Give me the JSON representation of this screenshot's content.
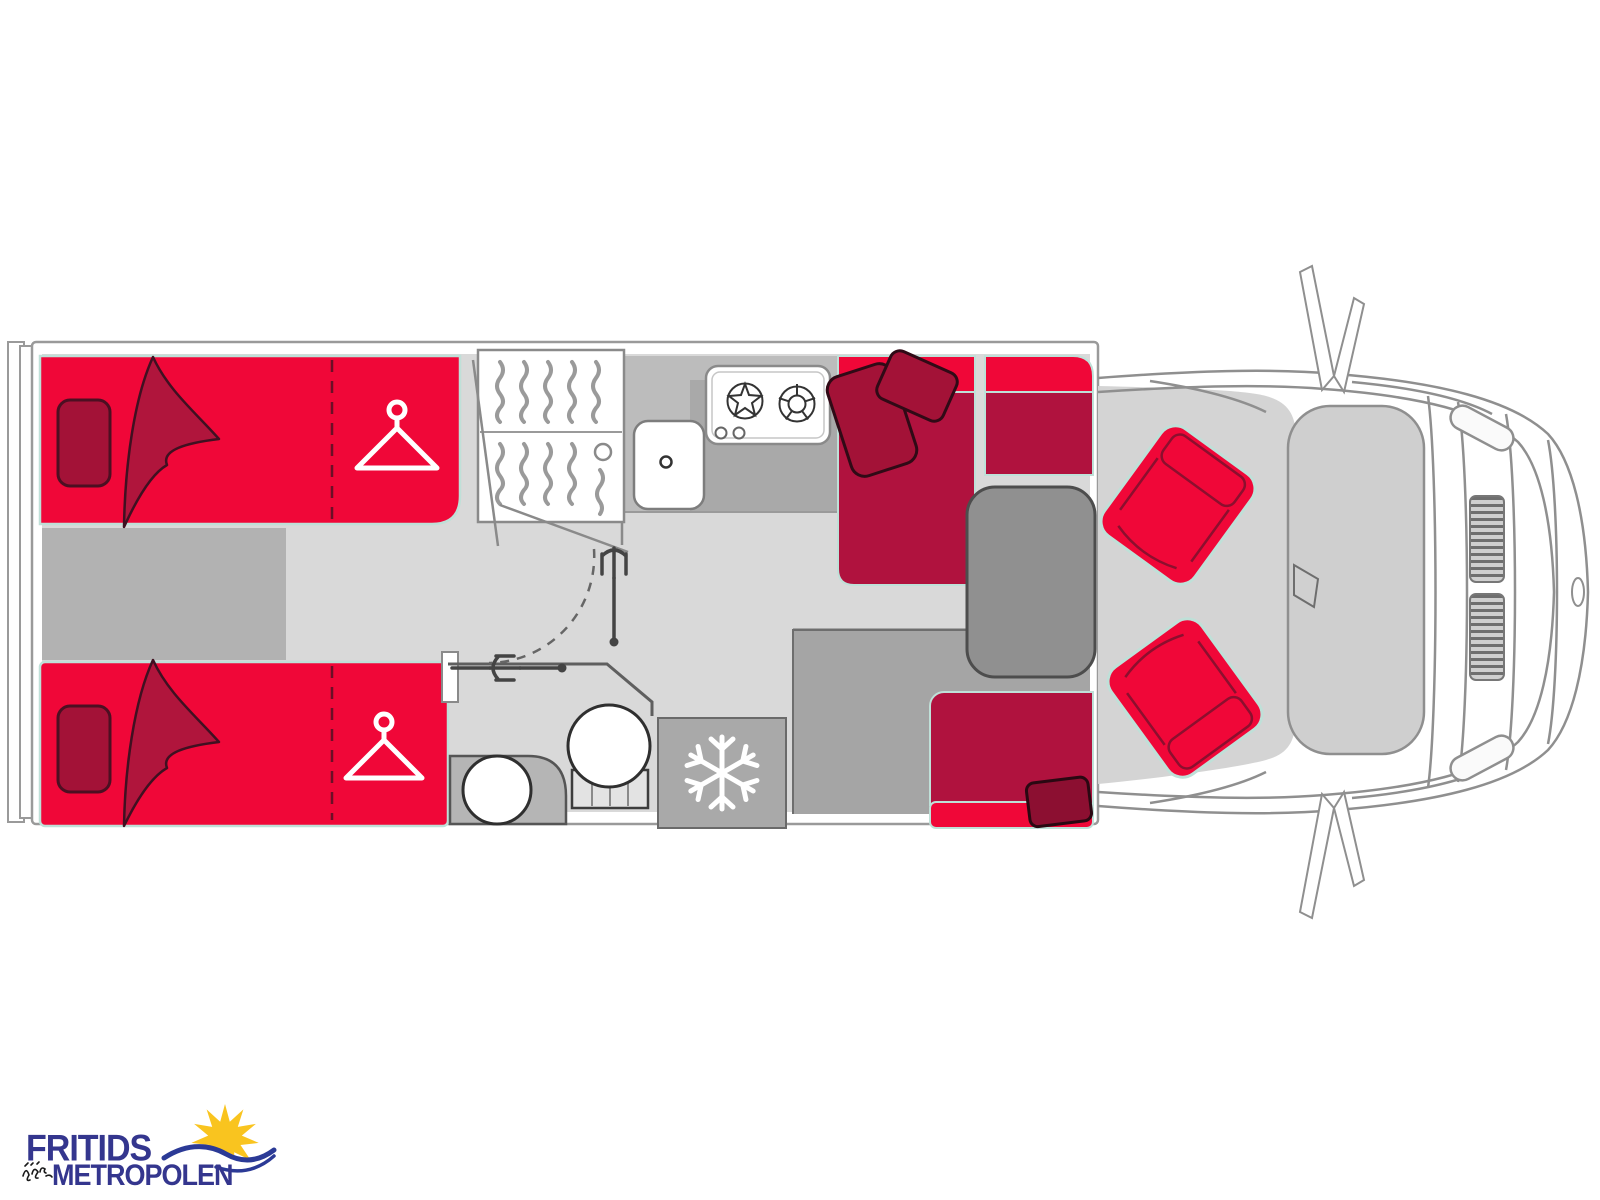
{
  "page": {
    "width": 1600,
    "height": 1200,
    "background": "#ffffff"
  },
  "logo": {
    "line1": "FRITIDS",
    "line2": "METROPOLEN",
    "text_color": "#34368e",
    "sun_color": "#f9c41f",
    "wave_color": "#2b3a96",
    "doodle_color": "#1a1a1a"
  },
  "floorplan": {
    "description": "Motorhome floor plan, top view: rear twin single beds with under-bed wardrobes, shelf unit, kitchen with sink and two-burner stove, bathroom with toilet and washbasin, refrigerator, dinette with L-sofa and table, two red swivel cab seats, van cab front outline",
    "colors": {
      "upholstery_red": "#f00738",
      "upholstery_dark_red": "#b0123e",
      "pillow_red": "#a31237",
      "trim_mint": "#bfe0d8",
      "floor_light": "#d9d9d9",
      "floor_mid": "#b2b2b2",
      "floor_dark": "#a5a5a5",
      "counter_gray": "#bcbcbc",
      "table_gray": "#8f8f8f",
      "outline_gray": "#8f8f8f",
      "fixture_line": "#3d3d3d",
      "white": "#ffffff"
    },
    "icons": {
      "hanger_icon": "clothes-hanger (custom svg)",
      "snowflake_icon": "❄",
      "burner_icon": "gas-burner",
      "door_swing_icon": "dashed-arc"
    },
    "features": [
      "twin-bed-top",
      "twin-bed-bottom",
      "wardrobe-hanger-top",
      "wardrobe-hanger-bottom",
      "shelf-unit",
      "kitchen-sink",
      "two-burner-stove",
      "bathroom-folding-door",
      "toilet",
      "washbasin",
      "refrigerator",
      "l-sofa",
      "side-seat",
      "dinette-table",
      "rear-bench",
      "swivel-seat-top",
      "swivel-seat-bottom",
      "van-cab-front",
      "side-mirror-top",
      "side-mirror-bottom"
    ]
  }
}
